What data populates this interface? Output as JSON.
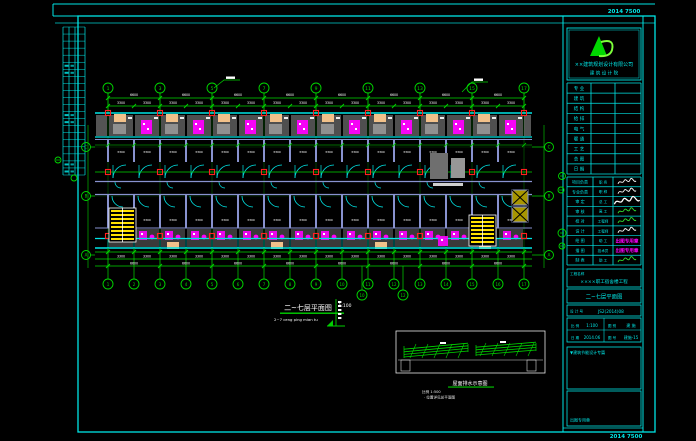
{
  "sheet": {
    "margin_code_top": "2014 7500",
    "margin_code_bottom": "2014 7500"
  },
  "plan": {
    "title": "二~七层平面图",
    "title_scale": "1:100",
    "subtitle": "2~7 ceng ping mian tu",
    "dim_bay": "3300",
    "dim_double_bay": "6600",
    "room_dim": "3300",
    "grid_top_labels": [
      "1",
      "3",
      "5",
      "7",
      "9",
      "11",
      "13",
      "15",
      "17"
    ],
    "grid_bottom_labels": [
      "1",
      "2",
      "3",
      "4",
      "5",
      "6",
      "7",
      "8",
      "9",
      "10",
      "11",
      "12",
      "13",
      "14",
      "15",
      "16",
      "17"
    ],
    "grid_extra_labels": [
      "10",
      "12"
    ],
    "grid_left_labels": [
      "C",
      "B",
      "A"
    ],
    "grid_right_labels": [
      "C",
      "B",
      "A"
    ]
  },
  "key_plan": {
    "title": "屋面排水示意图",
    "note1": "比例 1:500",
    "note2": "· 位置详见总平面图"
  },
  "title_block": {
    "logo_company_1": "××建筑规划设计有限公司",
    "logo_company_2": "建 筑 设 计 院",
    "sign_rows": [
      "专 业",
      "建 筑",
      "结 构",
      "给 排",
      "电 气",
      "暖 通",
      "工 艺",
      "总 图",
      "日 期"
    ],
    "staff_rows": [
      {
        "label": "项目负责",
        "role": "职 务",
        "sig": "w"
      },
      {
        "label": "专业负责",
        "role": "职 称",
        "sig": "w"
      },
      {
        "label": "审 定",
        "role": "总 工",
        "sig": "W"
      },
      {
        "label": "审 核",
        "role": "高 工",
        "sig": "g"
      },
      {
        "label": "校 对",
        "role": "工程师",
        "sig": "g"
      },
      {
        "label": "设 计",
        "role": "工程师",
        "sig": "w"
      },
      {
        "label": "绘 图",
        "role": "助 工",
        "sig": "m",
        "stamp": "出图专用章"
      },
      {
        "label": "描 图",
        "role": "技术员",
        "sig": "m",
        "stamp": "出图专用章"
      },
      {
        "label": "制 表",
        "role": "助 工",
        "sig": "g"
      }
    ],
    "project_label": "工程名称",
    "project_name": "××××职工宿舍楼工程",
    "drawing_name": "二~七层平面图",
    "serial_label": "设 计 号",
    "serial_value": "JS2(2014)08",
    "meta": [
      [
        "比 例",
        "1:100"
      ],
      [
        "图 别",
        "建 施"
      ],
      [
        "日 期",
        "2014.06"
      ],
      [
        "图 号",
        "建施-15"
      ]
    ],
    "stamp_note": "▼建筑节能设计专篇",
    "stamp_label": "出图专用章"
  }
}
